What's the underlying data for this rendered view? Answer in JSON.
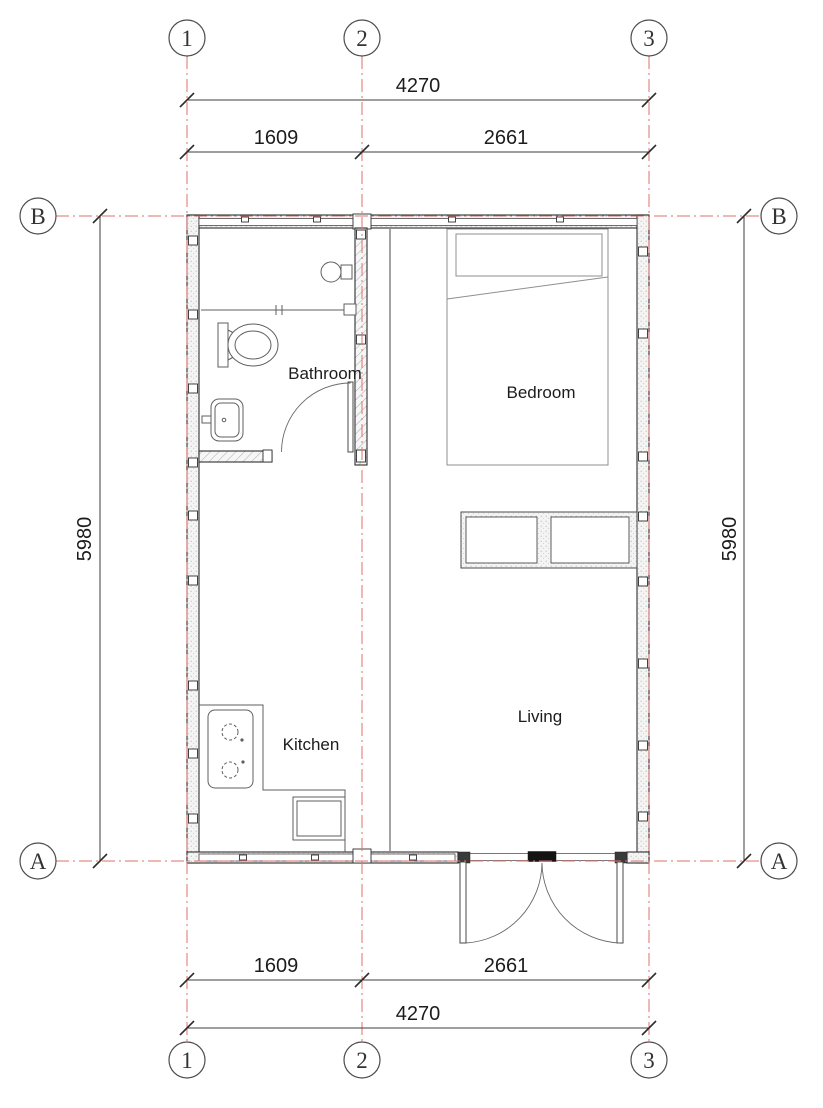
{
  "colors": {
    "grid_line_red": "#e0716b",
    "wall_line": "#2f2f2f",
    "dim_line": "#3d3d3d",
    "furniture_line": "#6a6a6a",
    "text": "#1c1c1c"
  },
  "grid": {
    "col_1": "1",
    "col_2": "2",
    "col_3": "3",
    "row_a": "A",
    "row_b": "B"
  },
  "dimensions": {
    "total_width_mm": "4270",
    "bay_left_mm": "1609",
    "bay_right_mm": "2661",
    "total_height_mm": "5980"
  },
  "rooms": {
    "bathroom": "Bathroom",
    "bedroom": "Bedroom",
    "kitchen": "Kitchen",
    "living": "Living"
  },
  "fixtures": [
    "shower-head",
    "shower-partition",
    "toilet",
    "washbasin",
    "bathroom-door",
    "bed",
    "pillow",
    "wardrobe",
    "cooktop",
    "kitchen-counter",
    "kitchen-sink",
    "double-entry-door",
    "interior-partition"
  ]
}
